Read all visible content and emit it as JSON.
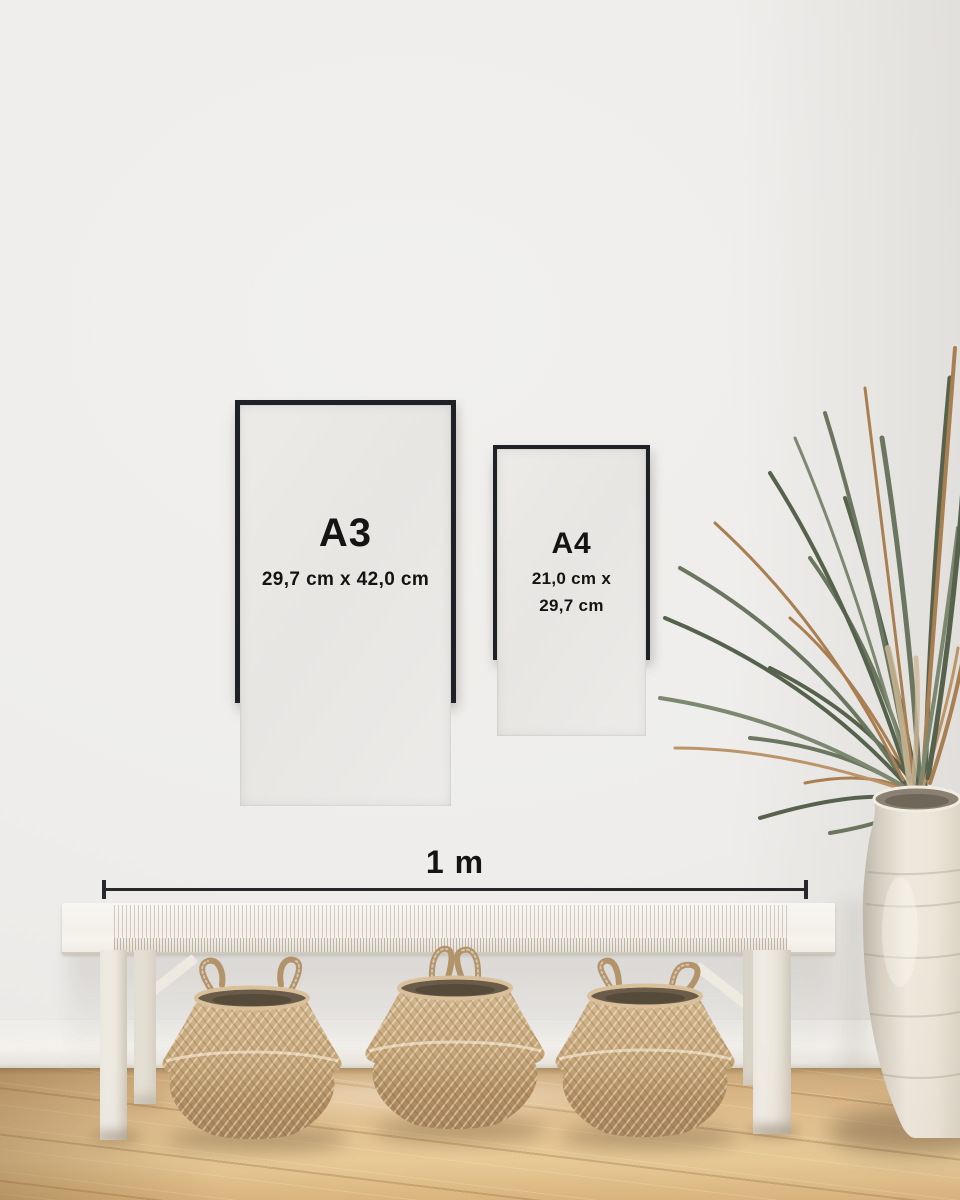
{
  "frames": {
    "a3": {
      "label": "A3",
      "dimensions": "29,7 cm x 42,0 cm"
    },
    "a4": {
      "label": "A4",
      "dimensions_line1": "21,0 cm x",
      "dimensions_line2": "29,7 cm"
    }
  },
  "scale_bar": {
    "label": "1 m"
  },
  "objects": {
    "bench": "white woven bench",
    "basket_left": "seagrass belly basket",
    "basket_middle": "seagrass belly basket",
    "basket_right": "seagrass belly basket",
    "plant": "dried palm fronds",
    "vase": "white ceramic floor vase"
  },
  "colors": {
    "wall": "#eeedeb",
    "baseboard": "#f3f1ed",
    "frame_border": "#1e2125",
    "frame_paper": "#eae8e5",
    "text": "#141414",
    "scale_line": "#26282b",
    "floor_light": "#e9cb97",
    "floor_mid": "#dcb783",
    "floor_dark": "#c09a68",
    "bench": "#f5f2ec",
    "basket_light": "#d3b88f",
    "basket_dark": "#a8845a",
    "plant_green": "#66715b",
    "plant_brown": "#a97f52",
    "vase": "#efe9dd"
  }
}
